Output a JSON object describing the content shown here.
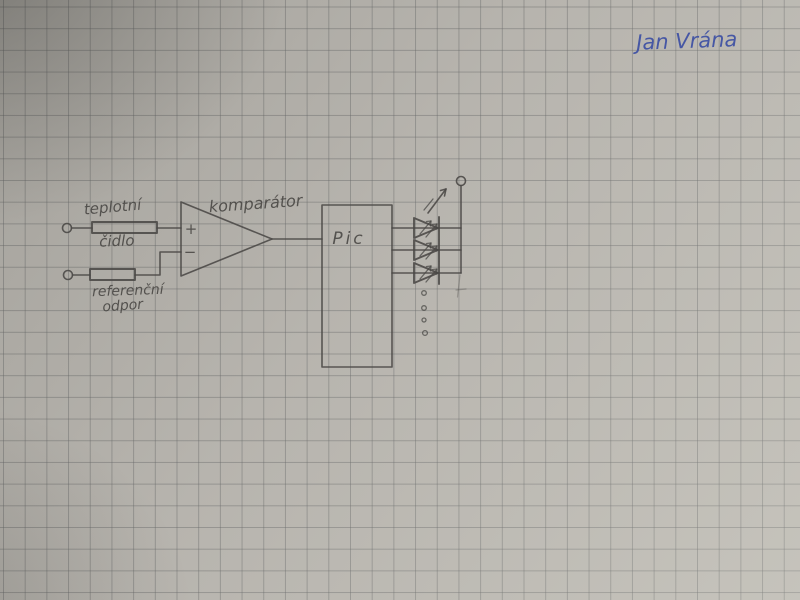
{
  "document": {
    "type": "hand-drawn circuit schematic photographed on squared graph paper"
  },
  "colors": {
    "paper": "#b7b4ae",
    "grid": "#6264646e",
    "pencil": "#4a4845",
    "ink": "#3d4fa3"
  },
  "signature": {
    "text": "Jan Vrána"
  },
  "schematic": {
    "labels": {
      "sensor_line1": "teplotní",
      "sensor_line2": "čidlo",
      "reference_line1": "referenční",
      "reference_line2": "odpor",
      "comparator": "komparátor",
      "plus_input": "+",
      "minus_input": "−",
      "mcu": "Pic"
    },
    "components": {
      "input_terminals": 2,
      "resistors": [
        "teplotní čidlo",
        "referenční odpor"
      ],
      "comparator": "komparátor",
      "comparator_inputs": [
        "+",
        "−"
      ],
      "mcu": "Pic",
      "led_count": 3,
      "continuation_dots": 4,
      "output_terminals": 1
    }
  }
}
